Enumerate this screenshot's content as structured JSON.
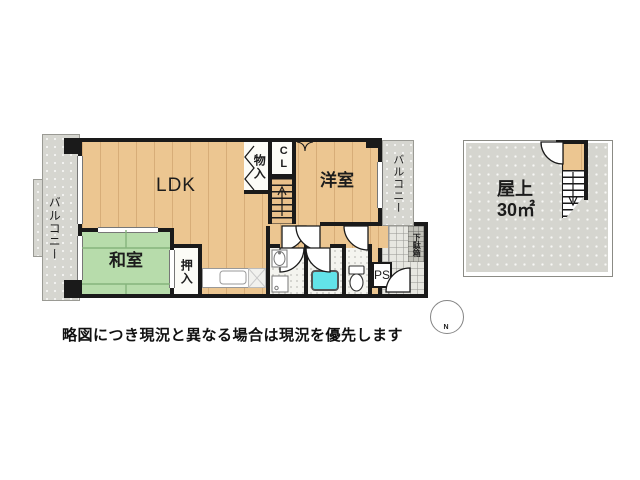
{
  "floorplan": {
    "unit": {
      "ldk": "LDK",
      "japanese_room": "和室",
      "western_room": "洋室",
      "oshiire_closet": "押入",
      "storage": "物入",
      "closet": "CL",
      "balcony_left": "バルコニー",
      "balcony_right": "バルコニー",
      "shoe_cabinet": "下駄箱",
      "pipe_space": "PS"
    },
    "rooftop": {
      "name": "屋上",
      "area": "30㎡"
    },
    "compass": {
      "north": "N"
    },
    "disclaimer": "略図につき現況と異なる場合は現況を優先します",
    "colors": {
      "wood_floor": "#ecc691",
      "tatami": "#b7dcab",
      "balcony": "#d6d6d0",
      "wall": "#1a1a1a",
      "bathtub": "#62e3e8"
    }
  }
}
